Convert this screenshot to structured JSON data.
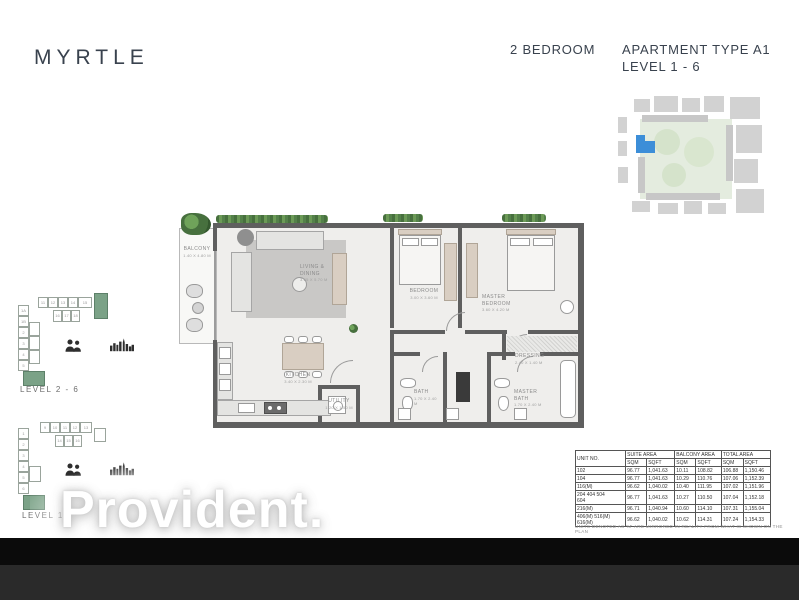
{
  "header": {
    "project": "MYRTLE",
    "bedrooms": "2 BEDROOM",
    "apartment_type": "APARTMENT TYPE A1",
    "level_range": "LEVEL 1 - 6"
  },
  "colors": {
    "text_dark": "#39424e",
    "highlight_green": "#7ba287",
    "site_map_blue": "#3c8ed8",
    "hedge_green": "#47703e"
  },
  "floor_plan": {
    "rooms": {
      "balcony": {
        "name": "BALCONY",
        "dims": "1.40 X 4.80 M"
      },
      "living": {
        "name": "LIVING &\nDINING",
        "dims": "3.65 X 5.70 M"
      },
      "bedroom": {
        "name": "BEDROOM",
        "dims": "3.00 X 3.60 M"
      },
      "master_bedroom": {
        "name": "MASTER\nBEDROOM",
        "dims": "3.60 X 4.20 M"
      },
      "kitchen": {
        "name": "KITCHEN",
        "dims": "3.40 X 2.30 M"
      },
      "utility": {
        "name": "UTILITY",
        "dims": "1.20 X 1.50 M"
      },
      "bath": {
        "name": "BATH",
        "dims": "1.70 X 2.40 M"
      },
      "master_bath": {
        "name": "MASTER\nBATH",
        "dims": "1.70 X 2.40 M"
      },
      "dressing": {
        "name": "DRESSING",
        "dims": "2.40 X 1.40 M"
      }
    }
  },
  "key_plans": [
    {
      "label": "LEVEL 2 - 6",
      "top": [
        "11",
        "12",
        "13",
        "14",
        "15"
      ],
      "mid": [
        "16",
        "17",
        "18"
      ],
      "left": [
        "1A",
        "1B",
        "2",
        "3",
        "4",
        "5"
      ]
    },
    {
      "label": "LEVEL 1",
      "top": [
        "9",
        "10",
        "11",
        "12",
        "13"
      ],
      "mid": [
        "14",
        "15",
        "16"
      ],
      "left": [
        "1",
        "2",
        "3",
        "4",
        "5",
        "6"
      ]
    }
  ],
  "area_table": {
    "col_unit": "UNIT NO.",
    "groups": [
      "SUITE AREA",
      "BALCONY AREA",
      "TOTAL AREA"
    ],
    "sub": [
      "SQM",
      "SQFT",
      "SQM",
      "SQFT",
      "SQM",
      "SQFT"
    ],
    "rows": [
      {
        "unit": "102",
        "s_sqm": "96.77",
        "s_sqft": "1,041.63",
        "b_sqm": "10.11",
        "b_sqft": "108.82",
        "t_sqm": "106.88",
        "t_sqft": "1,150.46"
      },
      {
        "unit": "104",
        "s_sqm": "96.77",
        "s_sqft": "1,041.63",
        "b_sqm": "10.29",
        "b_sqft": "110.76",
        "t_sqm": "107.06",
        "t_sqft": "1,152.39"
      },
      {
        "unit": "116(M)",
        "s_sqm": "96.62",
        "s_sqft": "1,040.02",
        "b_sqm": "10.40",
        "b_sqft": "111.95",
        "t_sqm": "107.02",
        "t_sqft": "1,151.96"
      },
      {
        "unit": "204      404      504\n604",
        "s_sqm": "96.77",
        "s_sqft": "1,041.63",
        "b_sqm": "10.27",
        "b_sqft": "110.50",
        "t_sqm": "107.04",
        "t_sqft": "1,152.18"
      },
      {
        "unit": "216(M)",
        "s_sqm": "96.71",
        "s_sqft": "1,040.94",
        "b_sqm": "10.60",
        "b_sqft": "114.10",
        "t_sqm": "107.31",
        "t_sqft": "1,155.04"
      },
      {
        "unit": "406(M)   516(M)   616(M)",
        "s_sqm": "96.62",
        "s_sqft": "1,040.02",
        "b_sqm": "10.62",
        "b_sqft": "114.31",
        "t_sqm": "107.24",
        "t_sqft": "1,154.33"
      }
    ],
    "footnote": "UNITS DENOTED AS 'M' ARE MIRRORED IN REALITY FROM WHAT IS SHOWN ON THE PLAN"
  },
  "watermark": {
    "text": "Provident."
  }
}
